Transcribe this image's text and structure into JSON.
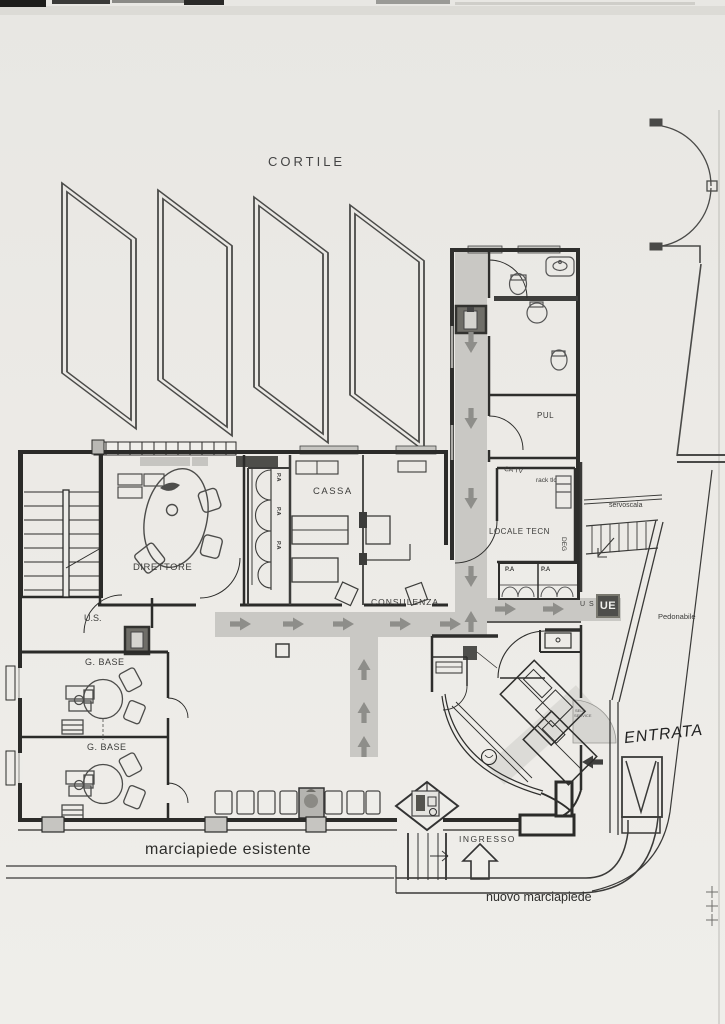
{
  "document": {
    "title": "floor-plan-scan",
    "labels": {
      "courtyard": "CORTILE",
      "cleaning_room": "PUL",
      "catv": "CA TV",
      "rack": "rack tlc",
      "technical_room": "LOCALE TECN",
      "deg": "DEG",
      "stairlift": "servoscala",
      "pedestrian_path": "Pedonabile",
      "exit_us": "U S",
      "exit_ue": "UE",
      "pa_cell_1": "P.A",
      "pa_cell_2": "P.A",
      "pa_teller_1": "P.A",
      "pa_teller_2": "P.A",
      "pa_teller_3": "P.A",
      "cash_room": "CASSA",
      "director_room": "DIRETTORE",
      "consulting_path": "CONSULENZA",
      "us_door": "U.S.",
      "g_base_room_1": "G. BASE",
      "g_base_room_2": "G. BASE",
      "entrance_handwritten": "ENTRATA",
      "entrance": "INGRESSO",
      "existing_sidewalk": "marciapiede esistente",
      "new_sidewalk": "nuovo marciapiede",
      "self_service_line1": "SELF",
      "self_service_line2": "SERVICE"
    },
    "colors": {
      "paper": "#e9e8e4",
      "ink": "#3a3a38",
      "wall": "#2b2b29",
      "corridor_fill": "#c9c8c4",
      "arrow": "#8e8e8a",
      "dark_box": "#4e4e4b",
      "exit_text": "#f0f0ec"
    }
  }
}
